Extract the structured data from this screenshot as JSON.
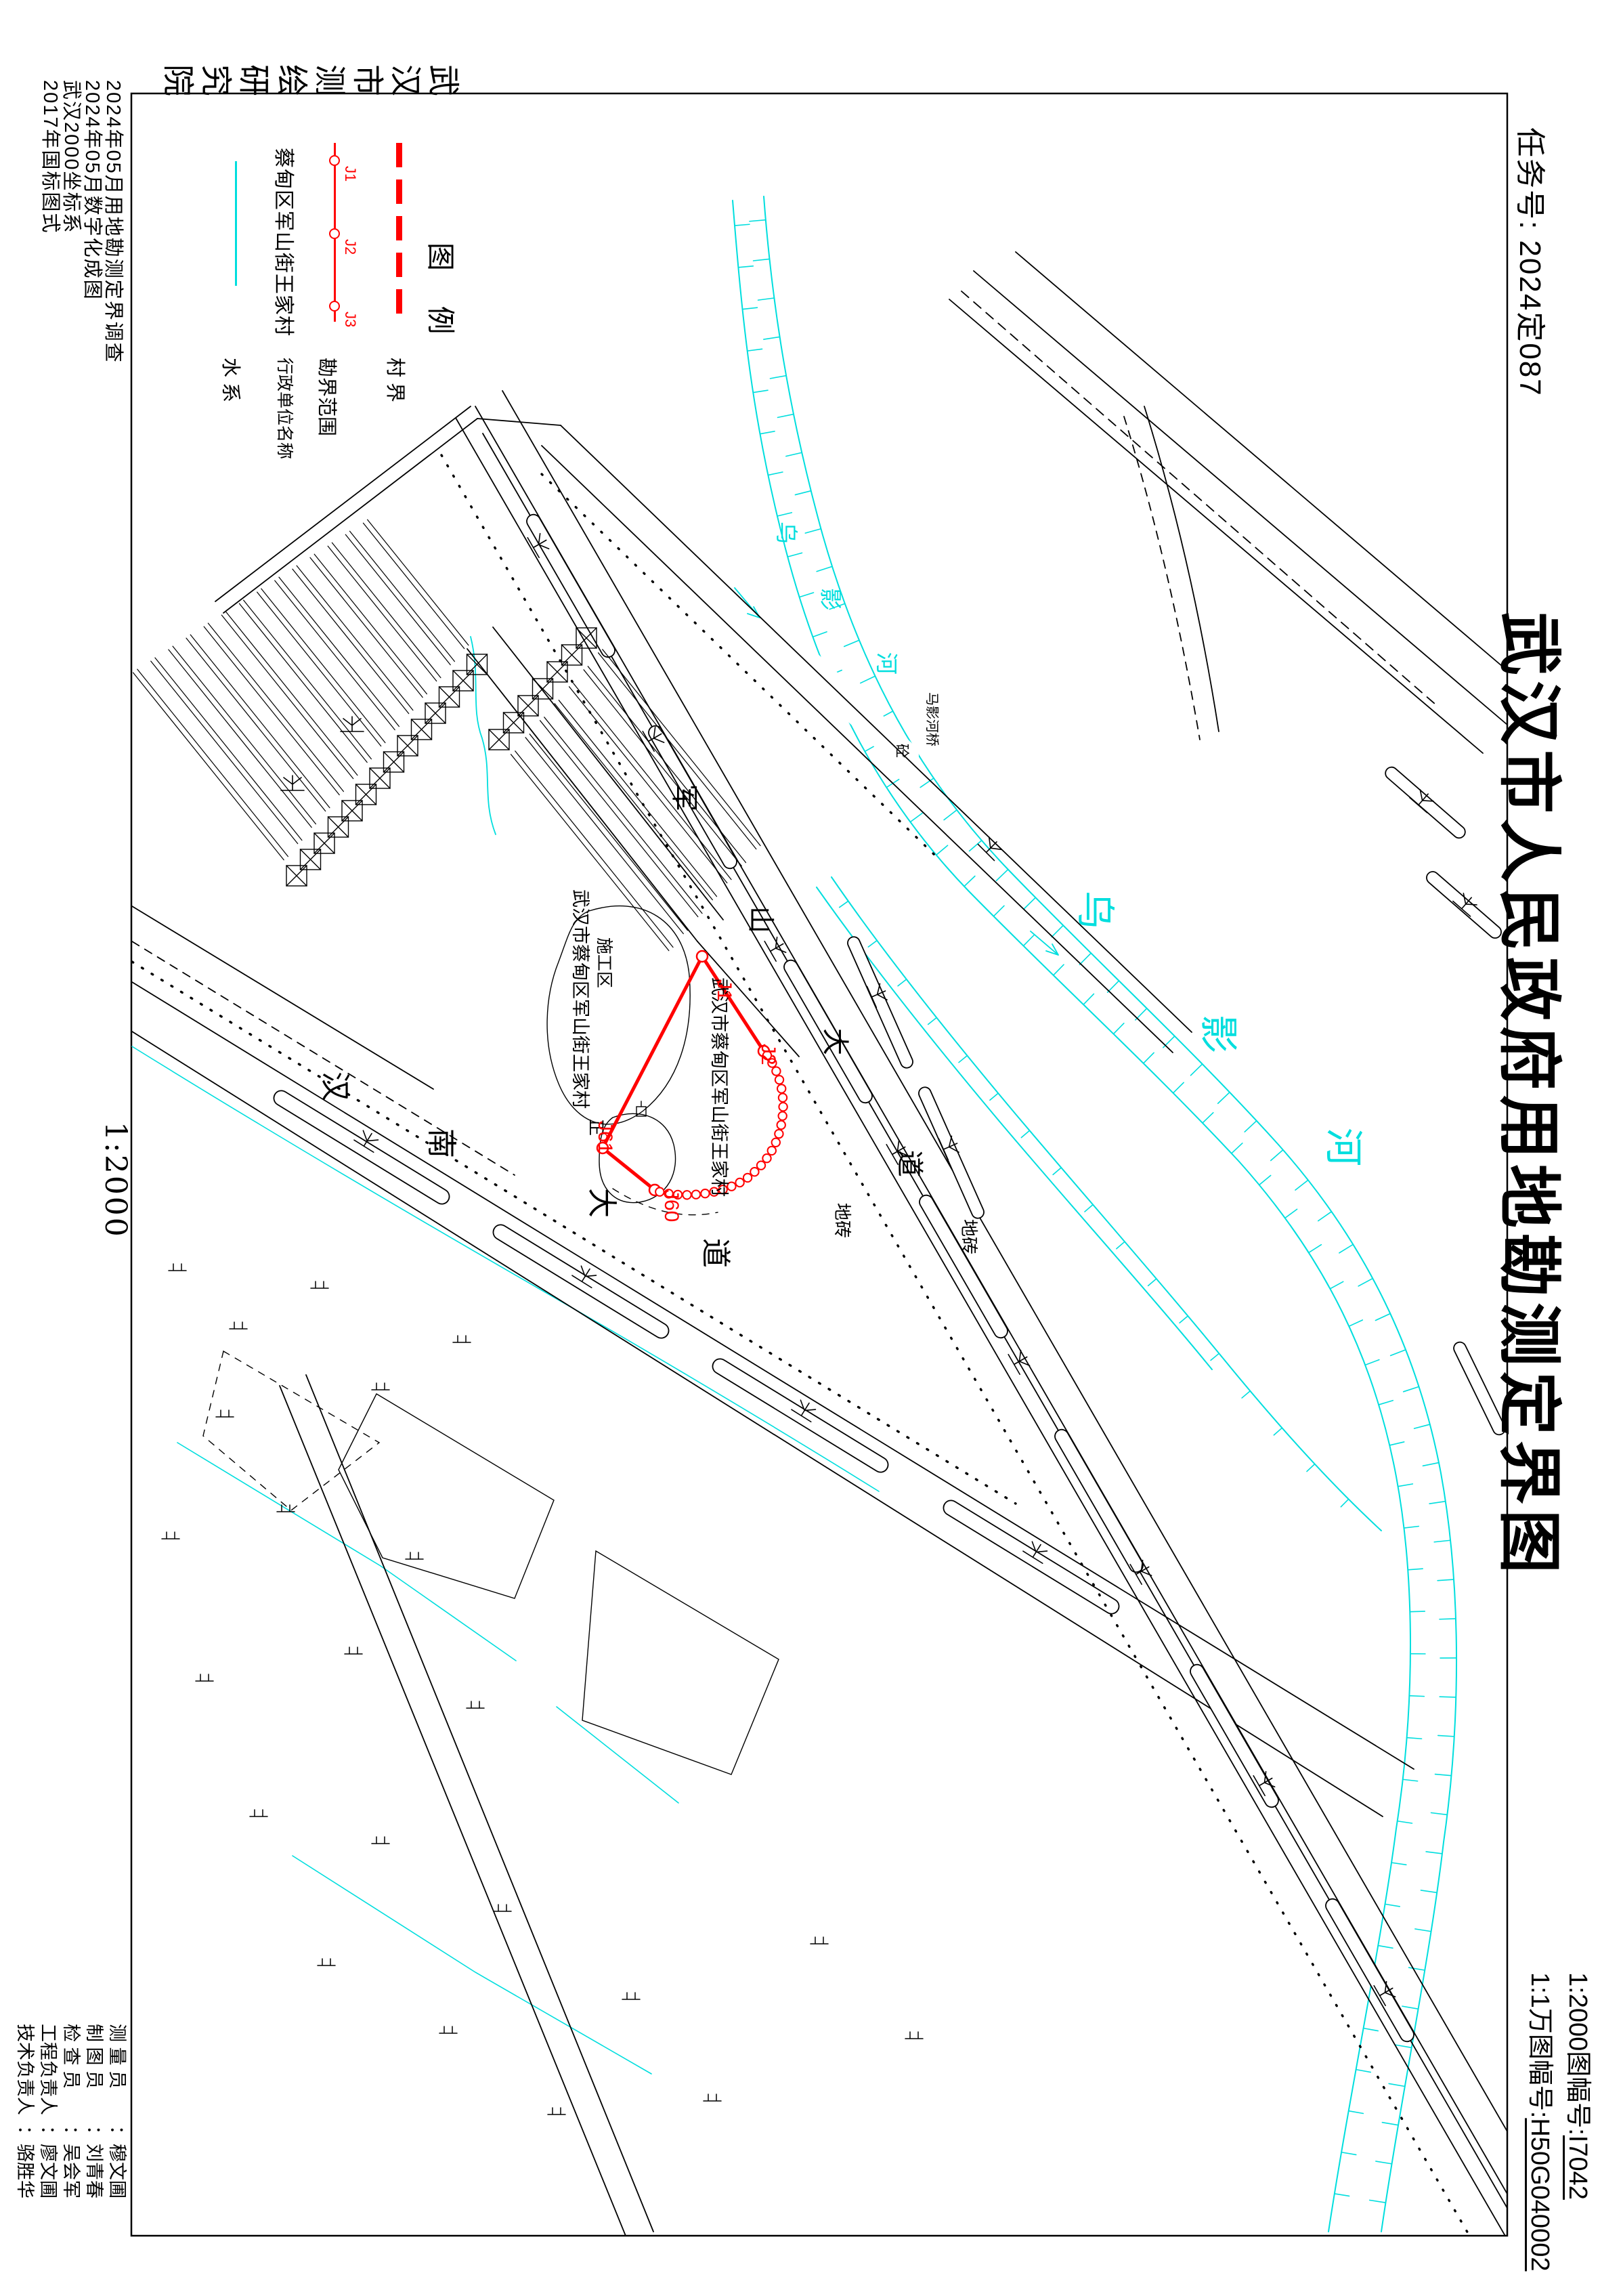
{
  "colors": {
    "boundary": "#ff0000",
    "water": "#00dede",
    "ink": "#000000"
  },
  "margin": {
    "agency": "武汉市测绘研究院",
    "task_no": "任务号: 2024定087",
    "title": "武汉市人民政府用地勘测定界图",
    "notes": [
      "2024年05月用地勘测定界调查",
      "2024年05月数字化成图",
      "武汉2000坐标系",
      "2017年国标图式"
    ],
    "scale": "1:2000",
    "sheet_2000_label": "1:2000图幅号:",
    "sheet_2000_value": "I7042",
    "sheet_10k_label": "1:1万图幅号:",
    "sheet_10k_value": "H50G040002",
    "personnel": [
      {
        "role": "测 量 员",
        "name": "穆文圃"
      },
      {
        "role": "制 图 员",
        "name": "刘青春"
      },
      {
        "role": "检 查 员",
        "name": "吴会军"
      },
      {
        "role": "工程负责人",
        "name": "廖文圃"
      },
      {
        "role": "技术负责人",
        "name": "骆胜华"
      }
    ]
  },
  "legend": {
    "title": "图 例",
    "village_boundary": "村 界",
    "survey_extent": "勘界范围",
    "points": [
      "J1",
      "J2",
      "J3"
    ],
    "admin_name": "行政单位名称",
    "admin_example": "蔡甸区军山街王家村",
    "water": "水 系"
  },
  "map": {
    "village": "武汉市蔡甸区军山街王家村",
    "construction": "施工区",
    "river": "乌影河",
    "bridge": "马影河桥",
    "concrete": "砼",
    "road_a": "汉南大道",
    "road_b": "军山大道",
    "paving": "地砖",
    "zheng": "正",
    "j1": "J1",
    "j2": "J2",
    "j60": "J60",
    "j61": "J61"
  }
}
